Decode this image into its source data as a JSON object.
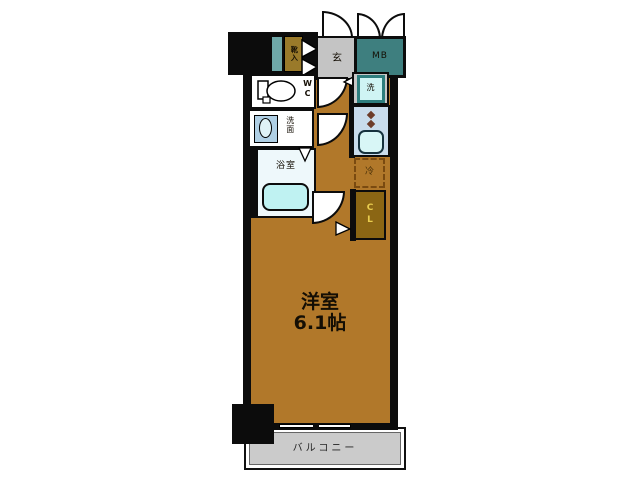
{
  "floorplan": {
    "title": "apartment-floorplan",
    "labels": {
      "shoe_box": "靴入",
      "entrance": "玄",
      "meter_box": "MB",
      "wc": "WC",
      "washroom": "洗面",
      "bathroom": "浴室",
      "washer": "洗",
      "fridge": "冷",
      "closet": "CL",
      "main_room_name": "洋室",
      "main_room_size": "6.1帖",
      "balcony": "バルコニー"
    },
    "colors": {
      "floor_brown": "#B1782A",
      "wall_black": "#0C0C0C",
      "entrance_gray": "#C4C4C4",
      "meter_box_teal": "#3E7F7F",
      "teal_strip": "#6FA8A8",
      "shoe_box_brown": "#9A7A2A",
      "closet_brown": "#8B6614",
      "closet_text_yellow": "#E8CC4E",
      "bathtub_cyan": "#BFF2F2",
      "kitchen_blue": "#C9DCEC",
      "sink_cyan": "#D8F6F6",
      "washer_teal_border": "#2E7E7E",
      "balcony_gray": "#CBCBCB"
    }
  }
}
